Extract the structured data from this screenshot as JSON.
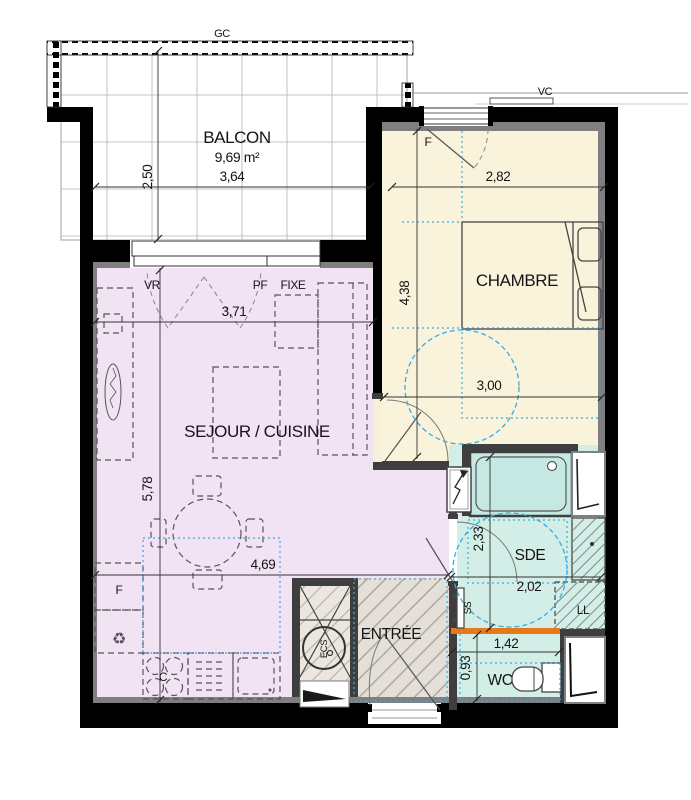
{
  "plan": {
    "rooms": {
      "balcon": {
        "name": "BALCON",
        "area": "9,69 m²"
      },
      "chambre": {
        "name": "CHAMBRE"
      },
      "sejour": {
        "name": "SEJOUR / CUISINE"
      },
      "sde": {
        "name": "SDE"
      },
      "wc": {
        "name": "WC"
      },
      "entree": {
        "name": "ENTRÉE"
      }
    },
    "annotations": {
      "gc": "GC",
      "vc": "VC",
      "vr": "VR",
      "pf": "PF",
      "fixe": "FIXE",
      "window_f": "F",
      "fridge_f": "F",
      "cooktop_c": "C",
      "water_heater": "ECS",
      "towel_dryer": "SS",
      "washing_machine": "LL"
    },
    "icons": {
      "recycle": "♻"
    },
    "dimensions": {
      "balcon_depth": "2,50",
      "balcon_width": "3,64",
      "chambre_window_width": "2,82",
      "chambre_depth": "4,38",
      "chambre_width": "3,00",
      "sejour_bay_width": "3,71",
      "sejour_depth": "5,78",
      "sejour_width": "4,69",
      "sde_depth": "2,33",
      "sde_width": "2,02",
      "wc_width": "1,42",
      "wc_depth": "0,93"
    },
    "colors": {
      "sejour": "#F1E2F4",
      "chambre": "#FAF3DB",
      "wet_rooms": "#D3EDE7",
      "shower": "#C6E8E2",
      "entree_floor": "#E4E0D9",
      "threshold_orange": "#E8791A",
      "accessibility_blue": "#38ACE4",
      "wall_black": "#000000",
      "wall_gray": "#7F7F7F"
    }
  }
}
